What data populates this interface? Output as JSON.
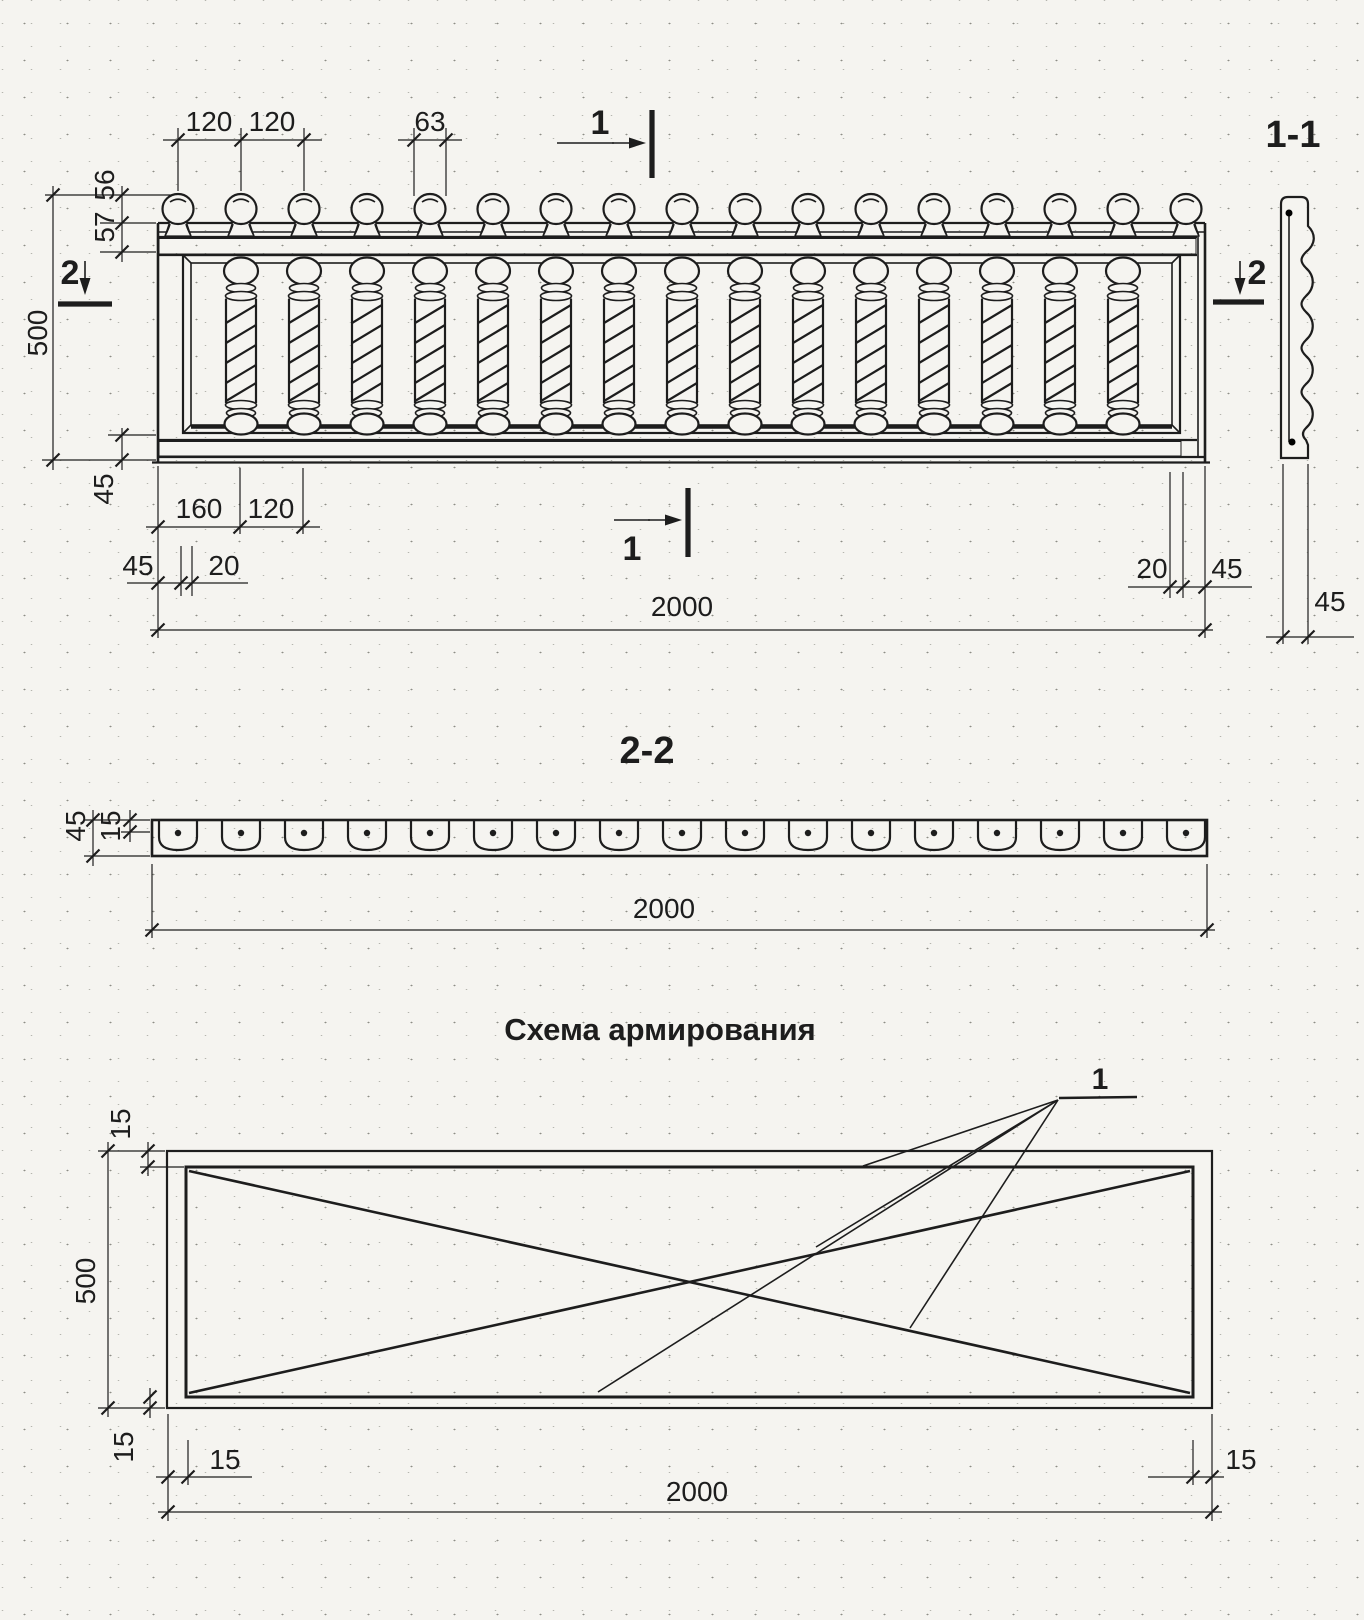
{
  "colors": {
    "ink": "#1d1d1d",
    "paper": "#f5f4f0"
  },
  "elevation": {
    "dims": {
      "top_a": "120",
      "top_b": "120",
      "top_c": "63",
      "left_a": "56",
      "left_b": "57",
      "height": "500",
      "left_c": "45",
      "bottom_a": "160",
      "bottom_b": "120",
      "bottom_c": "45",
      "bottom_d": "20",
      "bottom_e": "20",
      "bottom_f": "45",
      "width": "2000"
    },
    "marks": {
      "cut1_top": "1",
      "cut1_bottom": "1",
      "cut2_left": "2",
      "cut2_right": "2"
    }
  },
  "section11": {
    "title": "1-1",
    "dims": {
      "thickness": "45"
    }
  },
  "section22": {
    "title": "2-2",
    "dims": {
      "height": "45",
      "inset": "15",
      "width": "2000"
    }
  },
  "reinforcement": {
    "title": "Схема армирования",
    "callout_label": "1",
    "dims": {
      "top_inset": "15",
      "height": "500",
      "bottom_inset": "15",
      "left_inset": "15",
      "right_inset": "15",
      "width": "2000"
    }
  },
  "drawing_params": {
    "knobs": {
      "count": 17,
      "start": 178,
      "step": 63,
      "baseline_y": 223
    },
    "balusters": {
      "count": 15,
      "start": 241,
      "step": 63,
      "top_y": 255
    },
    "section_cells": {
      "count": 17,
      "start": 178,
      "step": 63,
      "top_y": 820
    }
  }
}
